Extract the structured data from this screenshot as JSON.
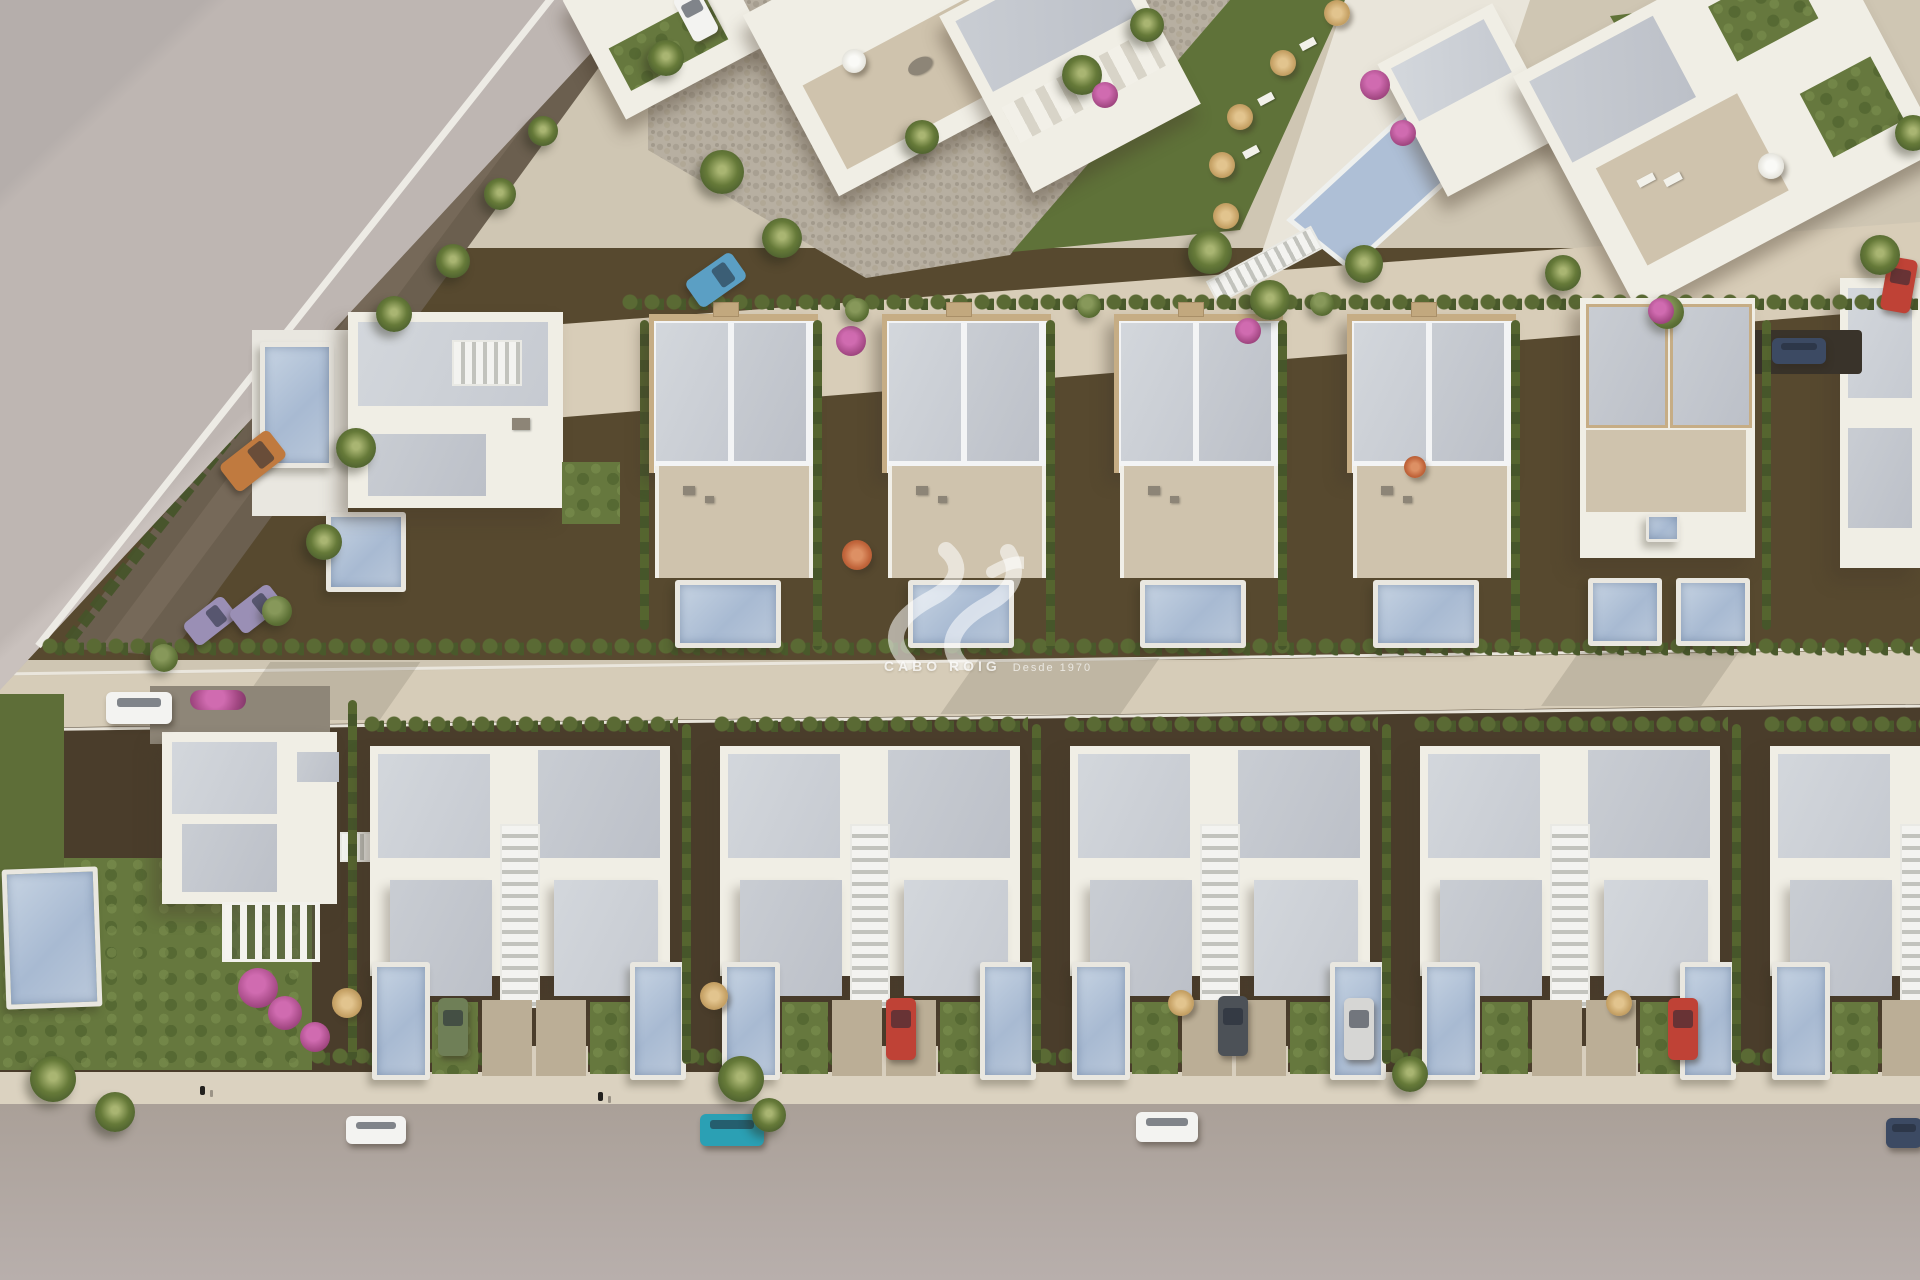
{
  "watermark": {
    "brand": "CABO ROIG",
    "tagline": "Desde 1970",
    "logo": "sv-wave-monogram"
  },
  "palette": {
    "canvas": "#b9b1ad",
    "wedge": "#bfb7b3",
    "street": "#d3c9b5",
    "road": "#aea49c",
    "soil": "#4a3d2b",
    "soil2": "#57492f",
    "lawn": "#66783e",
    "hedge": "#52602f",
    "wall": "#f0eee5",
    "roof": "#c9cdd3",
    "terrace": "#cfc3ad",
    "deck": "#e9e7e0",
    "water": "#aebfd6",
    "tan_trim": "#c6ad85",
    "cobble": "#b7afa1",
    "gravel_road": "#6b5f4f"
  },
  "vehicle_colors": {
    "white": "#f3f3f1",
    "silver": "#d6d6d4",
    "teal": "#2ba0b4",
    "blue": "#5b9fc4",
    "navy": "#3c4a63",
    "red": "#bf4236",
    "orange": "#c07a3f",
    "lavender": "#9a8fb5",
    "green": "#6f7f57",
    "darkgray": "#4c5157"
  }
}
